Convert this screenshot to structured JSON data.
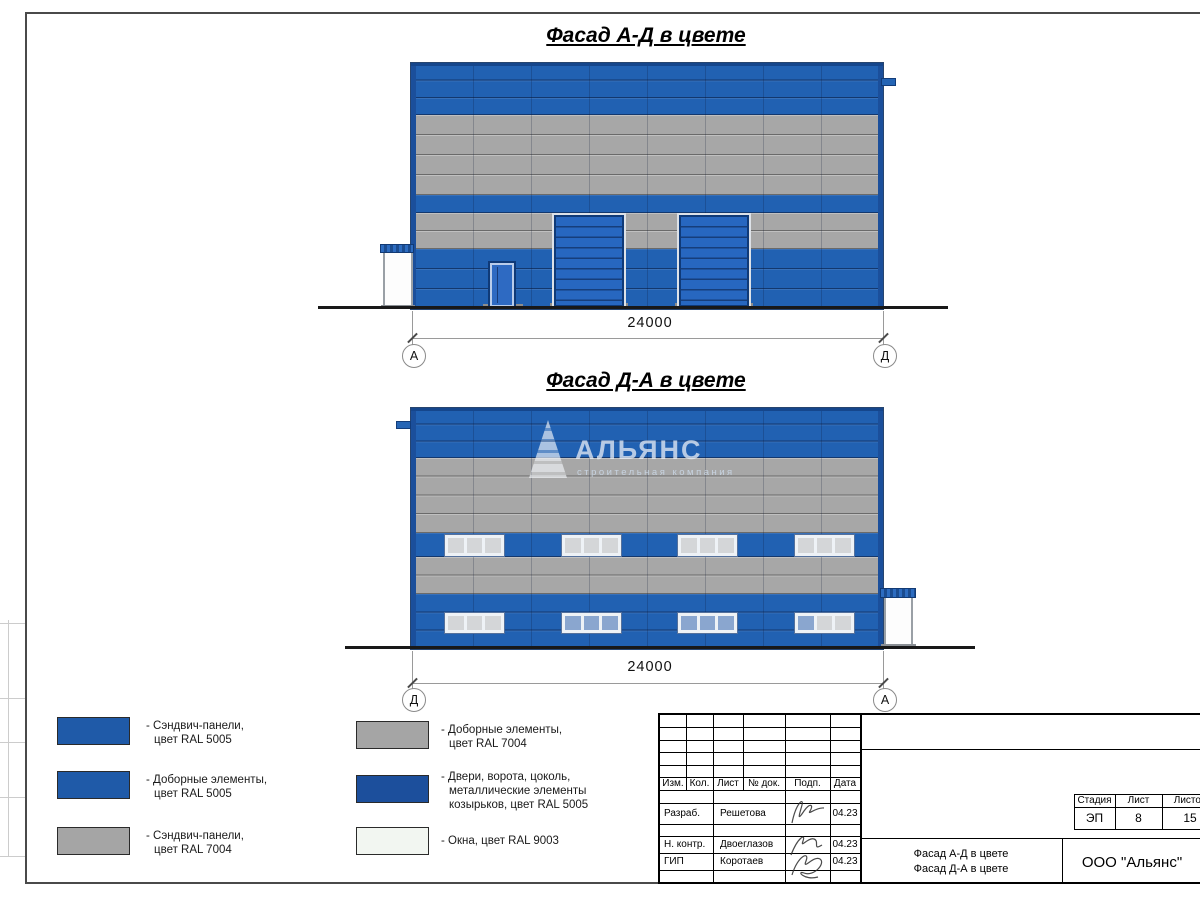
{
  "page": {
    "facade1_title": "Фасад А-Д в цвете",
    "facade2_title": "Фасад Д-А в цвете"
  },
  "facade1": {
    "dim": "24000",
    "axis_left": "А",
    "axis_right": "Д"
  },
  "facade2": {
    "dim": "24000",
    "axis_left": "Д",
    "axis_right": "А"
  },
  "watermark": {
    "logo": "АЛЬЯНС",
    "tagline": "строительная компания"
  },
  "legend": {
    "left": [
      {
        "swatch": "#1f5aa8",
        "lines": [
          "- Сэндвич-панели,",
          "цвет RAL 5005"
        ]
      },
      {
        "swatch": "#1f5aa8",
        "lines": [
          "- Доборные элементы,",
          "цвет RAL 5005"
        ]
      },
      {
        "swatch": "#a5a5a5",
        "lines": [
          "- Сэндвич-панели,",
          "цвет RAL 7004"
        ]
      }
    ],
    "right": [
      {
        "swatch": "#a5a5a5",
        "lines": [
          "- Доборные элементы,",
          "цвет RAL 7004"
        ]
      },
      {
        "swatch": "#1c4f9c",
        "lines": [
          "- Двери, ворота, цоколь,",
          "металлические элементы",
          "козырьков, цвет RAL 5005"
        ]
      },
      {
        "swatch": "#f2f6f1",
        "lines": [
          "- Окна, цвет RAL 9003"
        ]
      }
    ]
  },
  "titleblock": {
    "cols": [
      "Изм.",
      "Кол.",
      "Лист",
      "№ док.",
      "Подп.",
      "Дата"
    ],
    "rows": [
      {
        "role": "Разраб.",
        "name": "Решетова",
        "date": "04.23"
      },
      {
        "role": "Н. контр.",
        "name": "Двоеглазов",
        "date": "04.23"
      },
      {
        "role": "ГИП",
        "name": "Коротаев",
        "date": "04.23"
      }
    ],
    "doc_titles": [
      "Фасад А-Д в цвете",
      "Фасад Д-А в цвете"
    ],
    "stage_label": "Стадия",
    "stage": "ЭП",
    "sheet_label": "Лист",
    "sheet": "8",
    "sheets_label": "Листов",
    "sheets": "15",
    "company": "ООО \"Альянс\""
  },
  "colors": {
    "panel_blue": "#2161b2",
    "panel_gray": "#a7a7a7",
    "accent_dark_blue": "#1c4f9c",
    "window_white": "#f2f6f1"
  }
}
